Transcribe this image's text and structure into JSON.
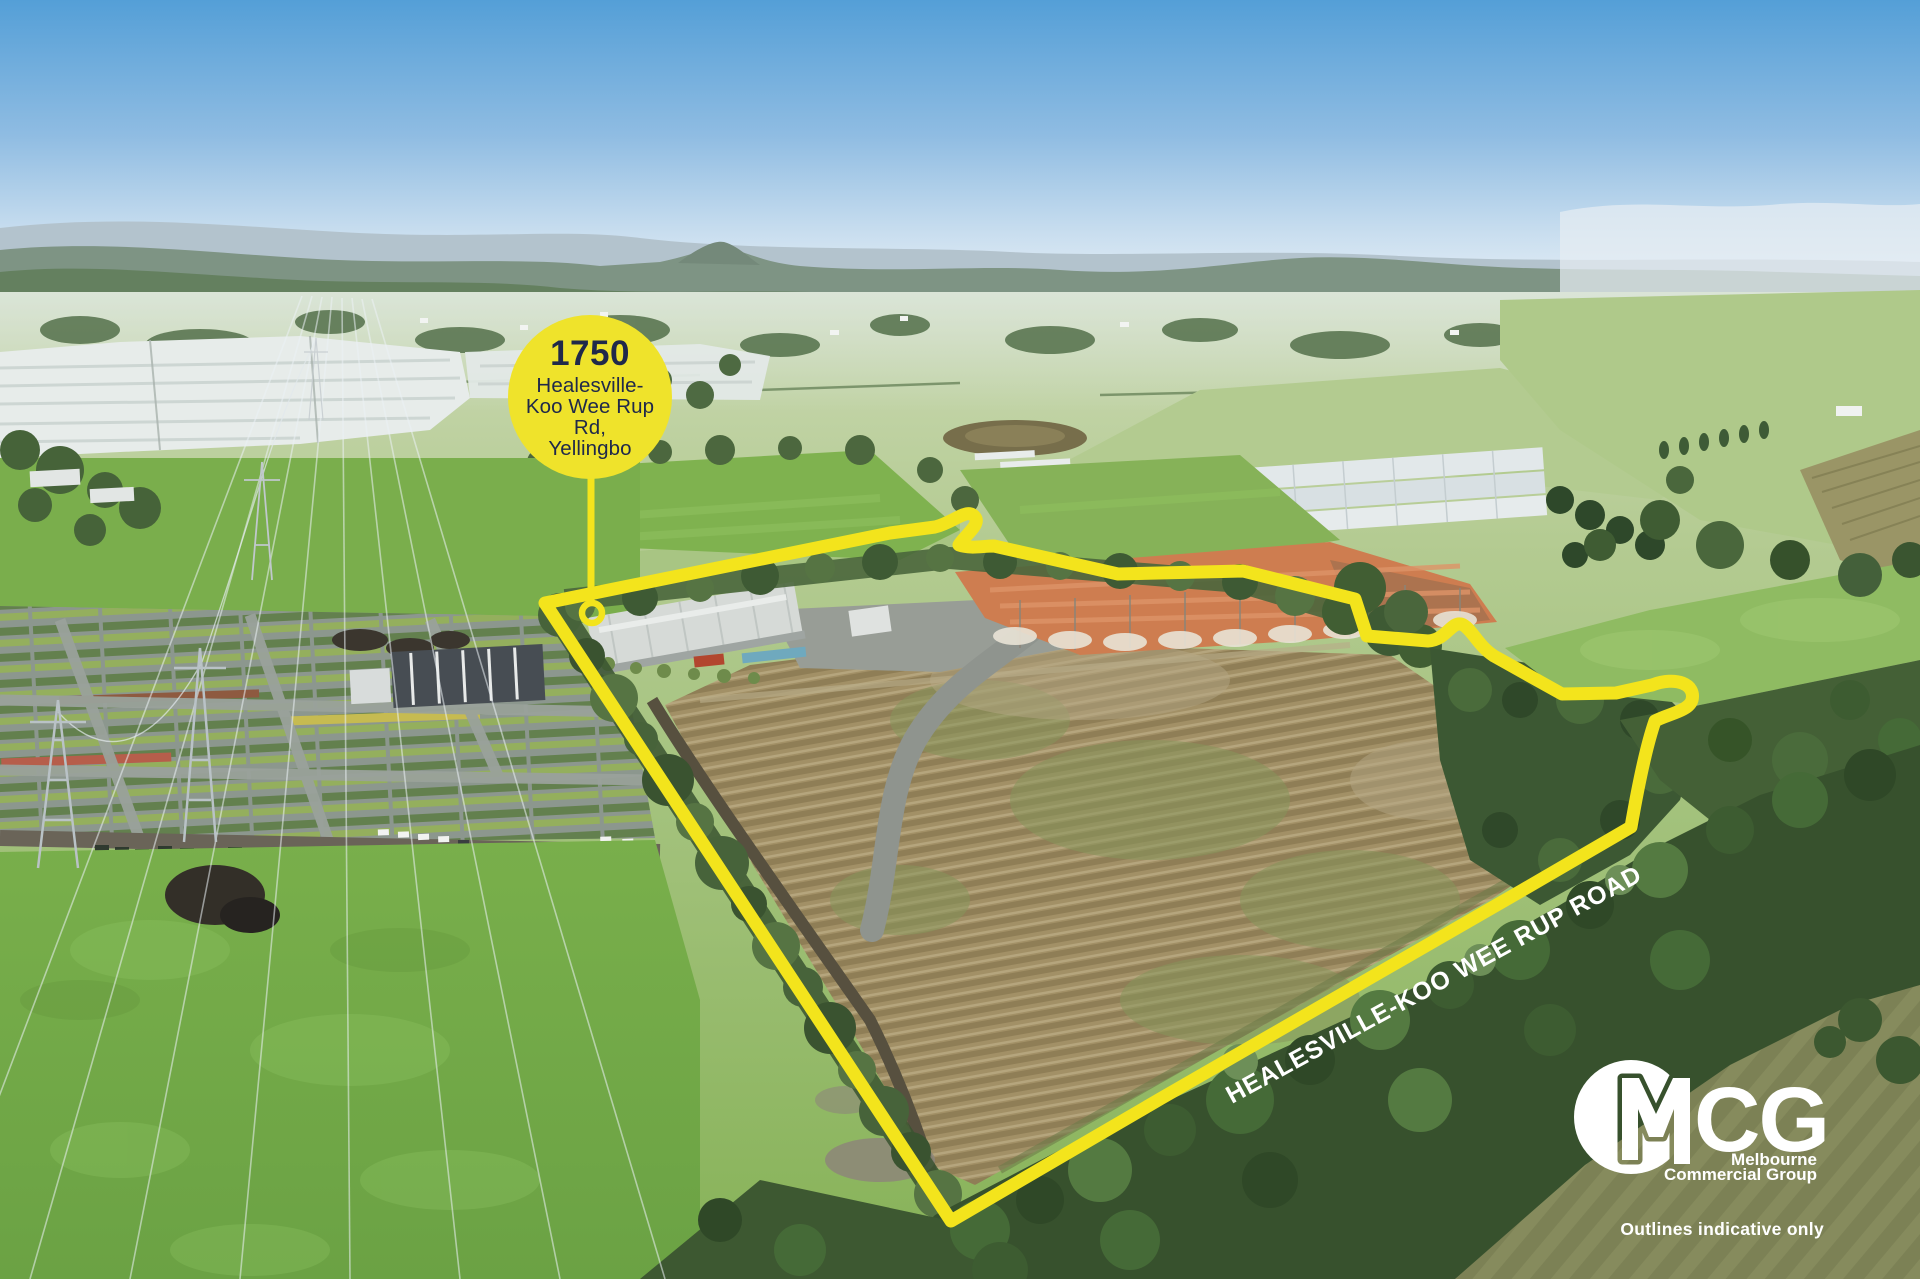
{
  "image": {
    "width": 1920,
    "height": 1279
  },
  "marker": {
    "number": "1750",
    "address_lines": [
      "Healesville-",
      "Koo Wee Rup Rd,",
      "Yellingbo"
    ]
  },
  "road_label": "HEALESVILLE-KOO WEE RUP ROAD",
  "logo": {
    "acronym": "MCG",
    "letters_cg": "CG",
    "name_line1": "Melbourne",
    "name_line2": "Commercial Group"
  },
  "disclaimer": "Outlines indicative only",
  "colors": {
    "accent_yellow": "#F3E41C",
    "badge_yellow": "#EFE32B",
    "text_navy": "#20294A",
    "label_white": "#FFFFFF"
  }
}
